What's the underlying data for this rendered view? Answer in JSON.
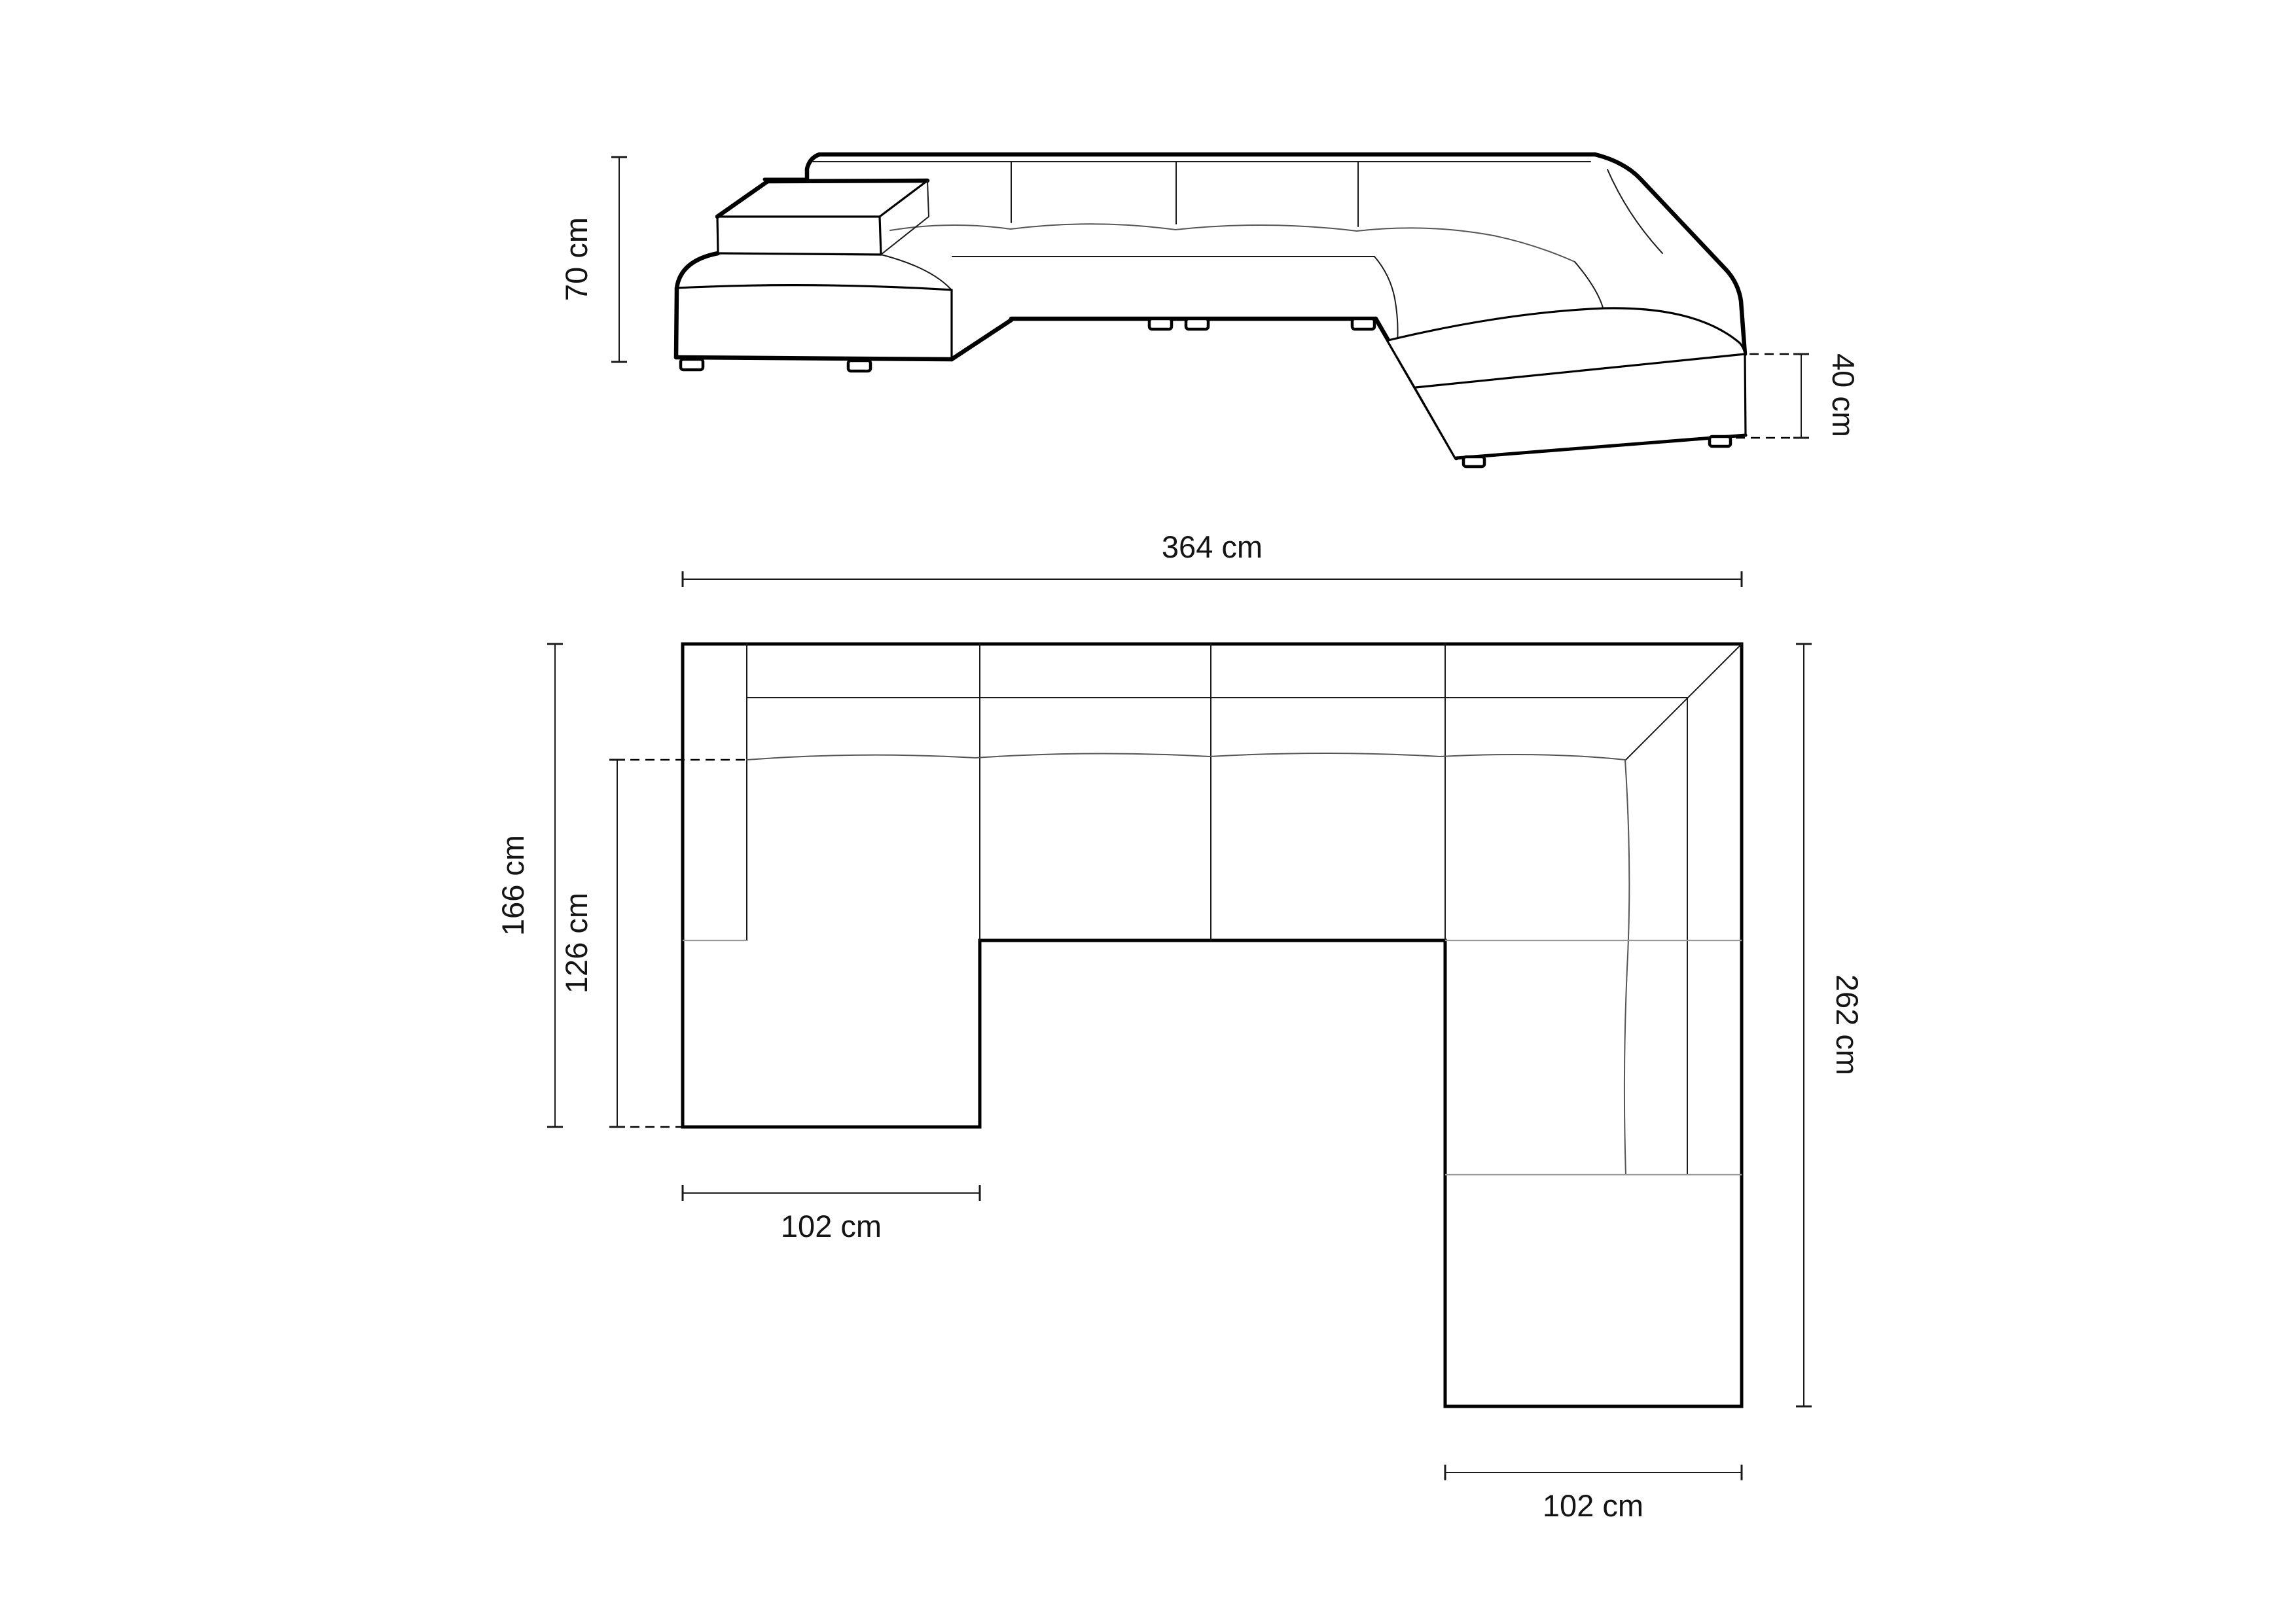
{
  "title": "U-shaped corner sofa dimension drawing",
  "views": {
    "front": {
      "name": "front elevation view",
      "dims": {
        "height": {
          "label": "70 cm",
          "value": 70
        },
        "seat_height": {
          "label": "40 cm",
          "value": 40
        }
      }
    },
    "plan": {
      "name": "top plan view",
      "dims": {
        "total_width": {
          "label": "364 cm",
          "value": 364
        },
        "left_depth": {
          "label": "166 cm",
          "value": 166
        },
        "left_chaise_inner": {
          "label": "126 cm",
          "value": 126
        },
        "left_chaise_width": {
          "label": "102 cm",
          "value": 102
        },
        "right_depth": {
          "label": "262 cm",
          "value": 262
        },
        "right_chaise_width": {
          "label": "102 cm",
          "value": 102
        }
      }
    }
  },
  "colors": {
    "background": "#ffffff",
    "line": "#000000",
    "seam": "#999999",
    "text": "#141414"
  }
}
